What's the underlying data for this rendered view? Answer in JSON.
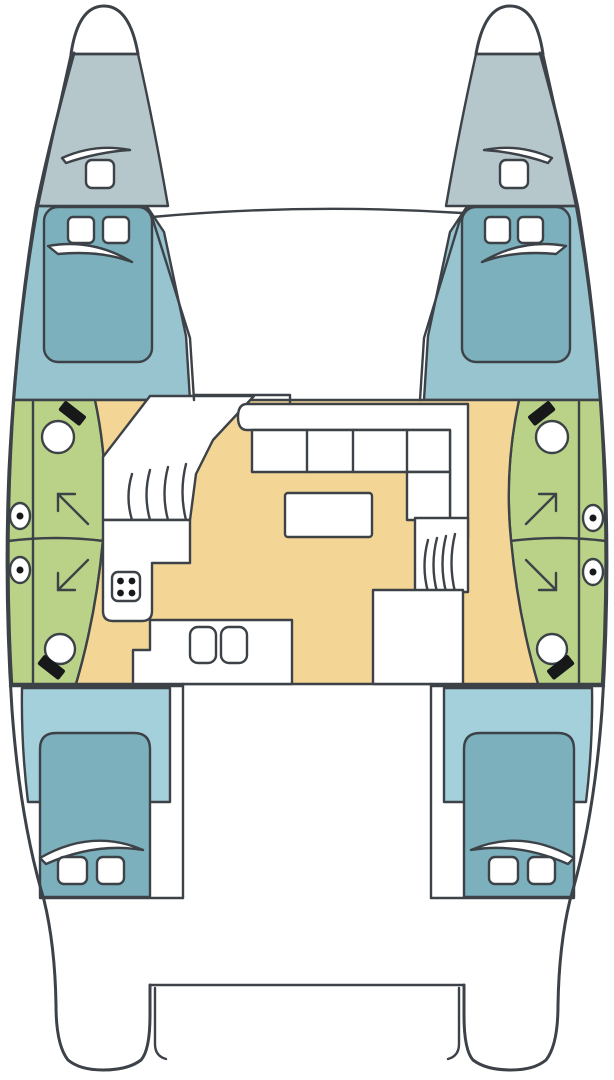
{
  "page": {
    "description": "Top-down interior layout plan of a cruising catamaran: twin bows with forepeak lockers, four double cabins, two heads with showers, central salon with L-settee, table, galley with stove and double sink, companionway stairs to each hull, and aft cockpit between the transoms",
    "background": "#ffffff"
  },
  "colors": {
    "outline": "#3c4247",
    "forepeak": "#b5c7cb",
    "forward_cabin": "#98c4d0",
    "aft_cabin": "#a3d0da",
    "berth": "#7cb0bd",
    "head": "#bad287",
    "salon": "#f3d595",
    "fixture_dark": "#16181a",
    "furniture_white": "#ffffff"
  },
  "icons": {
    "toilet-icon": "circle bowl with dark tank block",
    "shower-arrow-icon": "diagonal arrow marking shower stall",
    "porthole-icon": "ellipse with center dot",
    "stove-icon": "rounded square with four burner dots",
    "sink-icon": "two rounded sink bowls",
    "hatch-icon": "white rounded-square deck hatch",
    "berth-icon": "rounded rectangle double berth",
    "pillow-swoosh-icon": "curved wedge duvet fold mark",
    "stairs-icon": "curved tread lines of companionway steps"
  }
}
